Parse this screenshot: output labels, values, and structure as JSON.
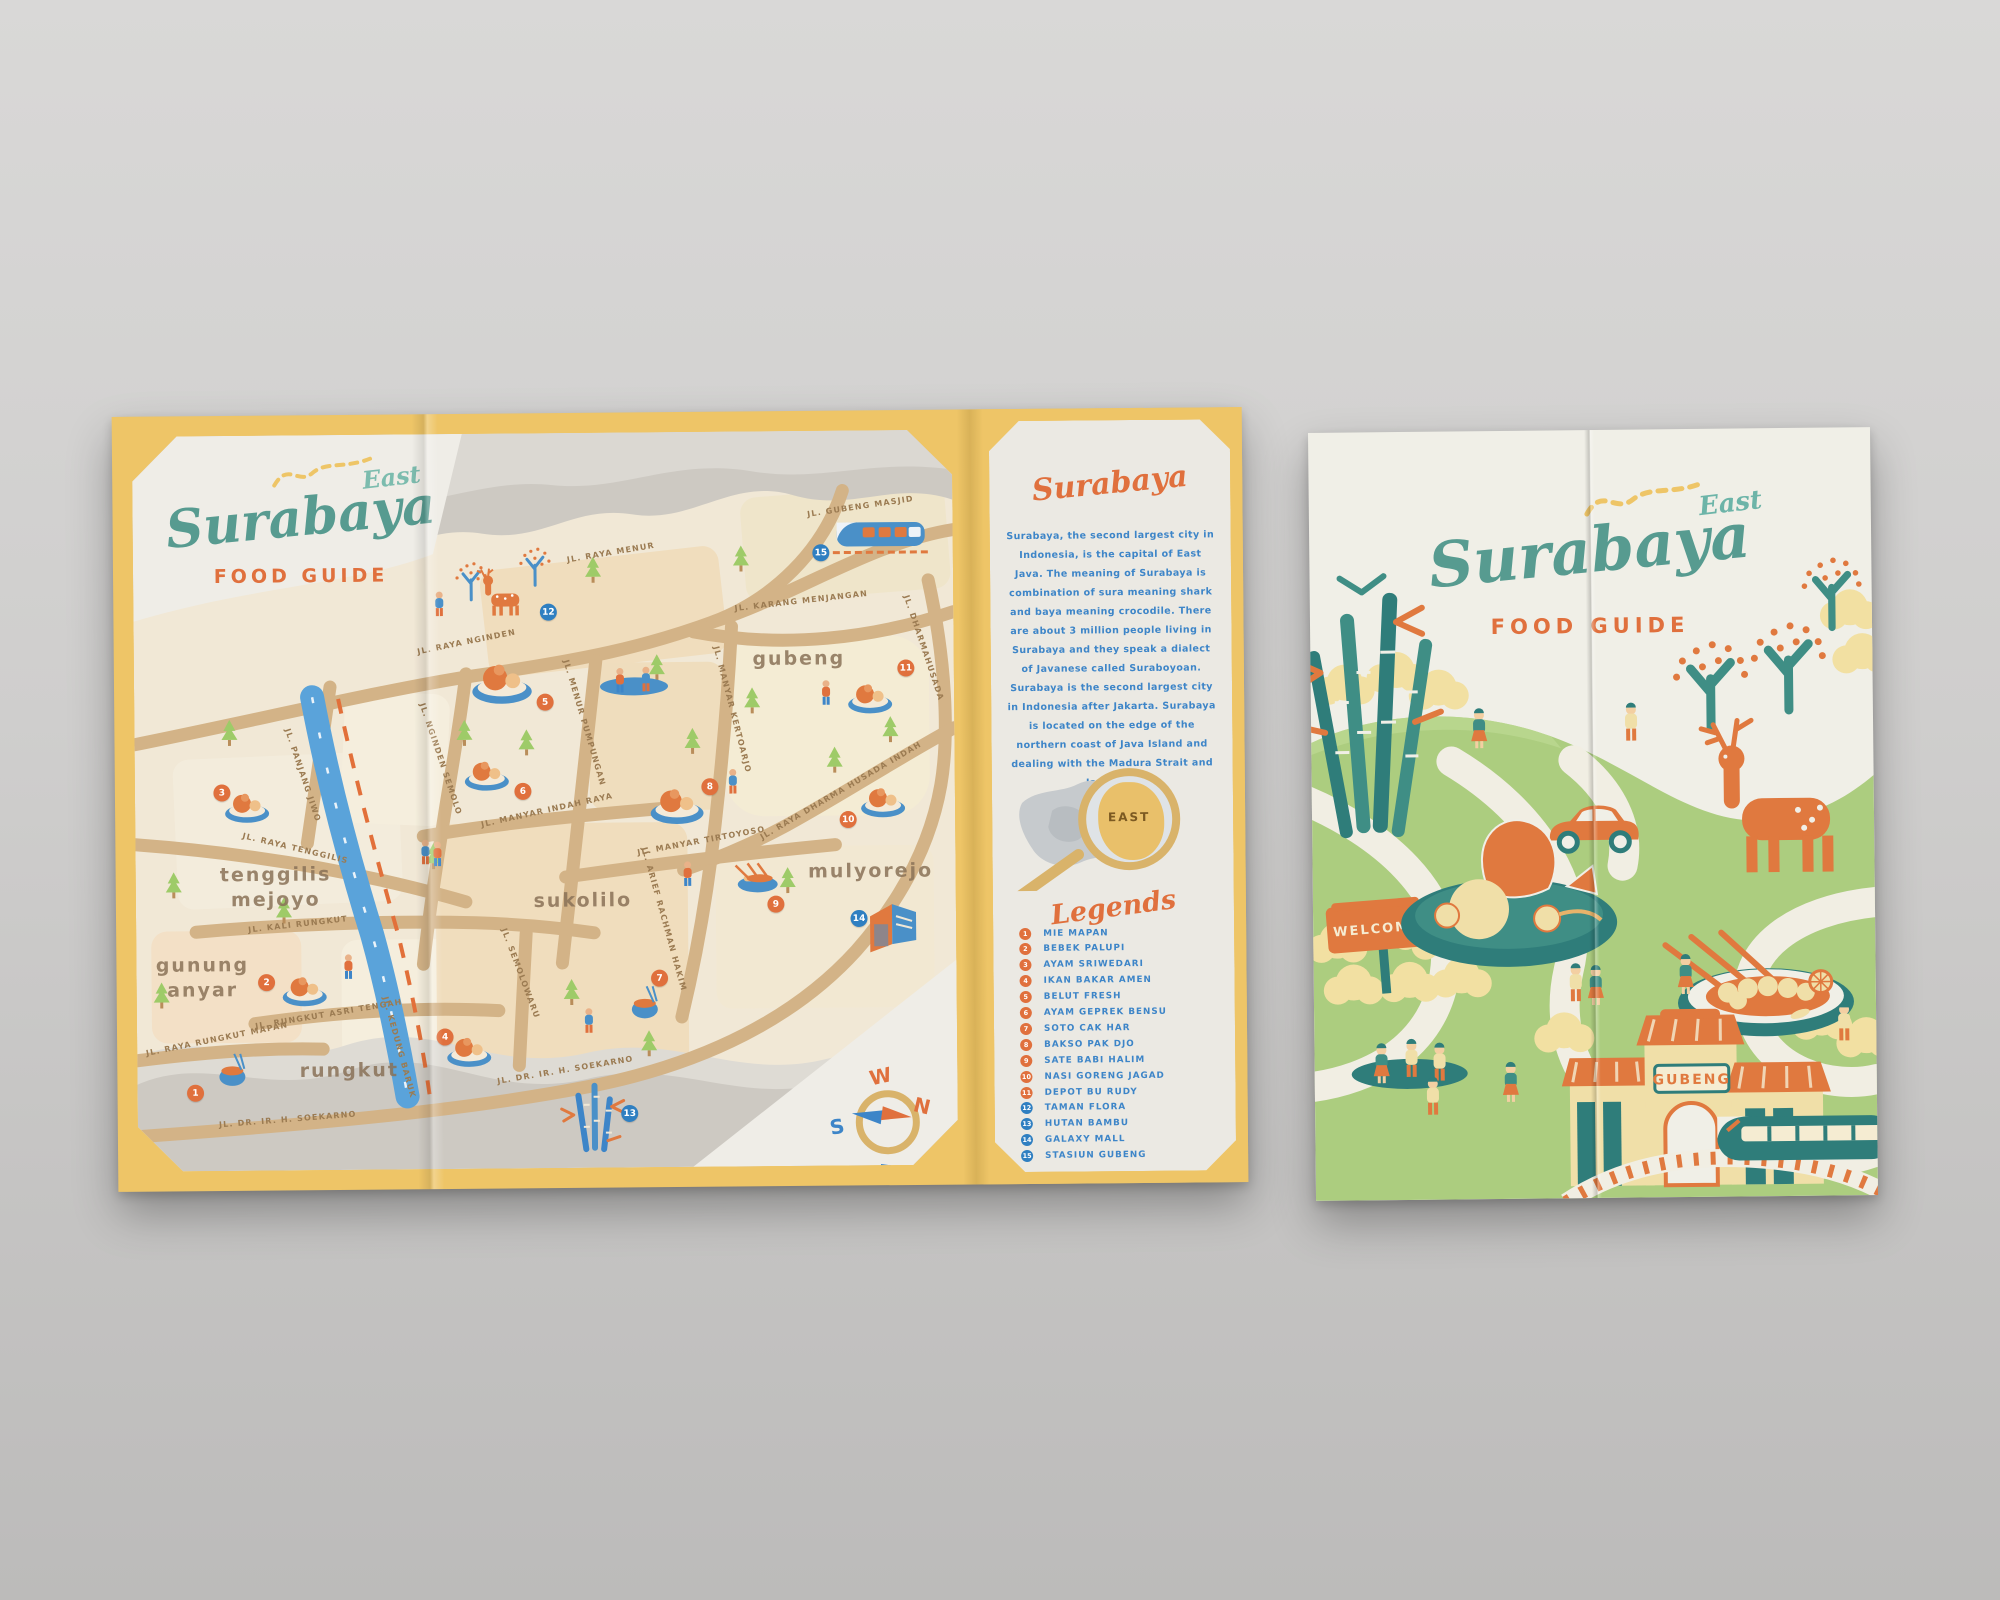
{
  "back_panel": {
    "title": "Surabaya",
    "title_accent": "East",
    "subtitle": "FOOD GUIDE"
  },
  "info_panel": {
    "heading": "Surabaya",
    "body": "Surabaya, the second largest city in Indonesia, is the capital of East Java. The meaning of Surabaya is combination of sura meaning shark and baya meaning crocodile. There are about 3 million people living in Surabaya and they speak a dialect of Javanese called Suraboyoan. Surabaya is the second largest city in Indonesia after Jakarta. Surabaya is located on the edge of the northern coast of Java Island and dealing with the Madura Strait and Java Sea.",
    "map_label": "EAST",
    "legend_title": "Legends",
    "legend": [
      {
        "num": "1",
        "label": "MIE MAPAN",
        "type": "food"
      },
      {
        "num": "2",
        "label": "BEBEK PALUPI",
        "type": "food"
      },
      {
        "num": "3",
        "label": "AYAM SRIWEDARI",
        "type": "food"
      },
      {
        "num": "4",
        "label": "IKAN BAKAR AMEN",
        "type": "food"
      },
      {
        "num": "5",
        "label": "BELUT FRESH",
        "type": "food"
      },
      {
        "num": "6",
        "label": "AYAM GEPREK BENSU",
        "type": "food"
      },
      {
        "num": "7",
        "label": "SOTO CAK HAR",
        "type": "food"
      },
      {
        "num": "8",
        "label": "BAKSO PAK DJO",
        "type": "food"
      },
      {
        "num": "9",
        "label": "SATE BABI HALIM",
        "type": "food"
      },
      {
        "num": "10",
        "label": "NASI GORENG JAGAD",
        "type": "food"
      },
      {
        "num": "11",
        "label": "DEPOT BU RUDY",
        "type": "food"
      },
      {
        "num": "12",
        "label": "TAMAN FLORA",
        "type": "place"
      },
      {
        "num": "13",
        "label": "HUTAN BAMBU",
        "type": "place"
      },
      {
        "num": "14",
        "label": "GALAXY MALL",
        "type": "place"
      },
      {
        "num": "15",
        "label": "STASIUN GUBENG",
        "type": "place"
      }
    ]
  },
  "map": {
    "compass": {
      "n": "N",
      "s": "S",
      "e": "E",
      "w": "W"
    },
    "districts": [
      {
        "label": "tenggilis mejoyo",
        "x": 140,
        "y": 452,
        "w": 130
      },
      {
        "label": "gunung anyar",
        "x": 66,
        "y": 542,
        "w": 110
      },
      {
        "label": "rungkut",
        "x": 212,
        "y": 636,
        "w": 160
      },
      {
        "label": "sukolilo",
        "x": 447,
        "y": 468,
        "w": 160
      },
      {
        "label": "gubeng",
        "x": 665,
        "y": 228,
        "w": 160
      },
      {
        "label": "mulyorejo",
        "x": 735,
        "y": 441,
        "w": 170
      }
    ],
    "streets": [
      {
        "label": "JL. GUBENG MASJID",
        "x": 728,
        "y": 76,
        "rot": -8
      },
      {
        "label": "JL. KARANG MENJANGAN",
        "x": 668,
        "y": 170,
        "rot": -6
      },
      {
        "label": "JL. RAYA MENUR",
        "x": 478,
        "y": 120,
        "rot": -9
      },
      {
        "label": "JL. RAYA NGINDEN",
        "x": 333,
        "y": 208,
        "rot": -11
      },
      {
        "label": "JL. NGINDEN SEMOLO",
        "x": 306,
        "y": 325,
        "rot": 72
      },
      {
        "label": "JL. PANJANG JIWO",
        "x": 168,
        "y": 340,
        "rot": 72
      },
      {
        "label": "JL. RAYA TENGGILIS",
        "x": 160,
        "y": 413,
        "rot": 14
      },
      {
        "label": "JL. KALI RUNGKUT",
        "x": 162,
        "y": 489,
        "rot": -6
      },
      {
        "label": "JL. RUNGKUT ASRI TENGAH",
        "x": 192,
        "y": 579,
        "rot": -9
      },
      {
        "label": "JL. RAYA RUNGKUT MAPAN",
        "x": 80,
        "y": 603,
        "rot": -11
      },
      {
        "label": "JL. KEDUNG BARUK",
        "x": 262,
        "y": 613,
        "rot": 75
      },
      {
        "label": "JL. DR. IR. H. SOEKARNO",
        "x": 150,
        "y": 684,
        "rot": -4
      },
      {
        "label": "JL. DR. IR. H. SOEKARNO",
        "x": 428,
        "y": 637,
        "rot": -9
      },
      {
        "label": "JL. MANYAR INDAH RAYA",
        "x": 412,
        "y": 377,
        "rot": -12
      },
      {
        "label": "JL. MENUR PUMPUNGAN",
        "x": 450,
        "y": 290,
        "rot": 74
      },
      {
        "label": "JL. MANYAR KERTOARJO",
        "x": 598,
        "y": 278,
        "rot": 76
      },
      {
        "label": "JL. MANYAR TIRTOYOSO",
        "x": 566,
        "y": 409,
        "rot": -10
      },
      {
        "label": "JL. ARIEF RACHMAN HAKIM",
        "x": 528,
        "y": 487,
        "rot": 75
      },
      {
        "label": "JL. SEMOLOWARU",
        "x": 384,
        "y": 540,
        "rot": 70
      },
      {
        "label": "JL. RAYA DHARMA HUSADA INDAH",
        "x": 706,
        "y": 360,
        "rot": -30
      },
      {
        "label": "JL. DHARMAHUSADA",
        "x": 790,
        "y": 218,
        "rot": 72
      }
    ],
    "markers": [
      {
        "num": "1",
        "x": 58,
        "y": 657,
        "type": "food"
      },
      {
        "num": "2",
        "x": 130,
        "y": 547,
        "type": "food"
      },
      {
        "num": "3",
        "x": 87,
        "y": 357,
        "type": "food"
      },
      {
        "num": "4",
        "x": 308,
        "y": 603,
        "type": "food"
      },
      {
        "num": "5",
        "x": 411,
        "y": 269,
        "type": "food"
      },
      {
        "num": "6",
        "x": 388,
        "y": 358,
        "type": "food"
      },
      {
        "num": "7",
        "x": 523,
        "y": 546,
        "type": "food"
      },
      {
        "num": "8",
        "x": 575,
        "y": 355,
        "type": "food"
      },
      {
        "num": "9",
        "x": 640,
        "y": 473,
        "type": "food"
      },
      {
        "num": "10",
        "x": 713,
        "y": 389,
        "type": "food"
      },
      {
        "num": "11",
        "x": 772,
        "y": 238,
        "type": "food"
      },
      {
        "num": "12",
        "x": 415,
        "y": 179,
        "type": "place"
      },
      {
        "num": "13",
        "x": 492,
        "y": 681,
        "type": "place"
      },
      {
        "num": "14",
        "x": 723,
        "y": 488,
        "type": "place"
      },
      {
        "num": "15",
        "x": 688,
        "y": 122,
        "type": "place"
      }
    ]
  },
  "cover": {
    "title": "Surabaya",
    "title_accent": "East",
    "subtitle": "FOOD GUIDE",
    "welcome_sign": "WELCOME",
    "station_sign": "GUBENG"
  },
  "colors": {
    "teal": "#579b90",
    "teal_light": "#7cbcae",
    "orange": "#e0703d",
    "text_blue": "#3d85c8",
    "marker_blue": "#2f7fc1",
    "gold": "#eec567",
    "road_tan": "#d3b387",
    "map_cream": "#f1e8d6",
    "grey_land": "#cdc9c2",
    "cover_green": "#accd7f"
  }
}
